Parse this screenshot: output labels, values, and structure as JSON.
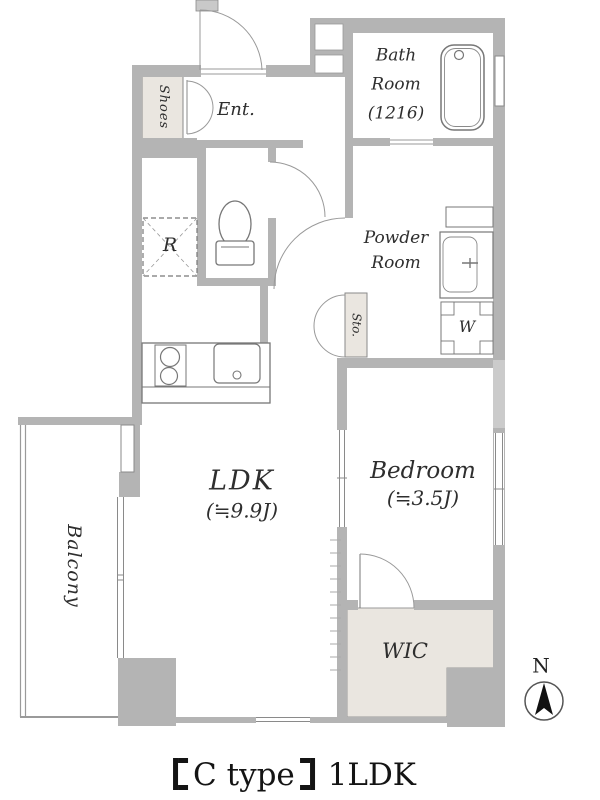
{
  "floorplan": {
    "rooms": {
      "entrance": {
        "label": "Ent."
      },
      "shoes": {
        "label": "Shoes"
      },
      "bath": {
        "line1": "Bath",
        "line2": "Room",
        "size": "(1216)"
      },
      "powder": {
        "line1": "Powder",
        "line2": "Room"
      },
      "storage": {
        "label": "Sto."
      },
      "ldk": {
        "label": "LDK",
        "size": "(≒9.9J)"
      },
      "bedroom": {
        "label": "Bedroom",
        "size": "(≒3.5J)"
      },
      "wic": {
        "label": "WIC"
      },
      "balcony": {
        "label": "Balcony"
      }
    },
    "fixtures": {
      "refrigerator_label": "R",
      "washer_label": "W"
    },
    "compass": {
      "north_label": "N"
    },
    "caption": {
      "full_text": "【C type】 1LDK",
      "type_name": "C type",
      "layout_type": "1LDK"
    },
    "colors": {
      "wall": "#b4b4b4",
      "wall_light": "#cbcbcb",
      "closet_fill": "#eae6e0",
      "line": "#777777"
    }
  }
}
